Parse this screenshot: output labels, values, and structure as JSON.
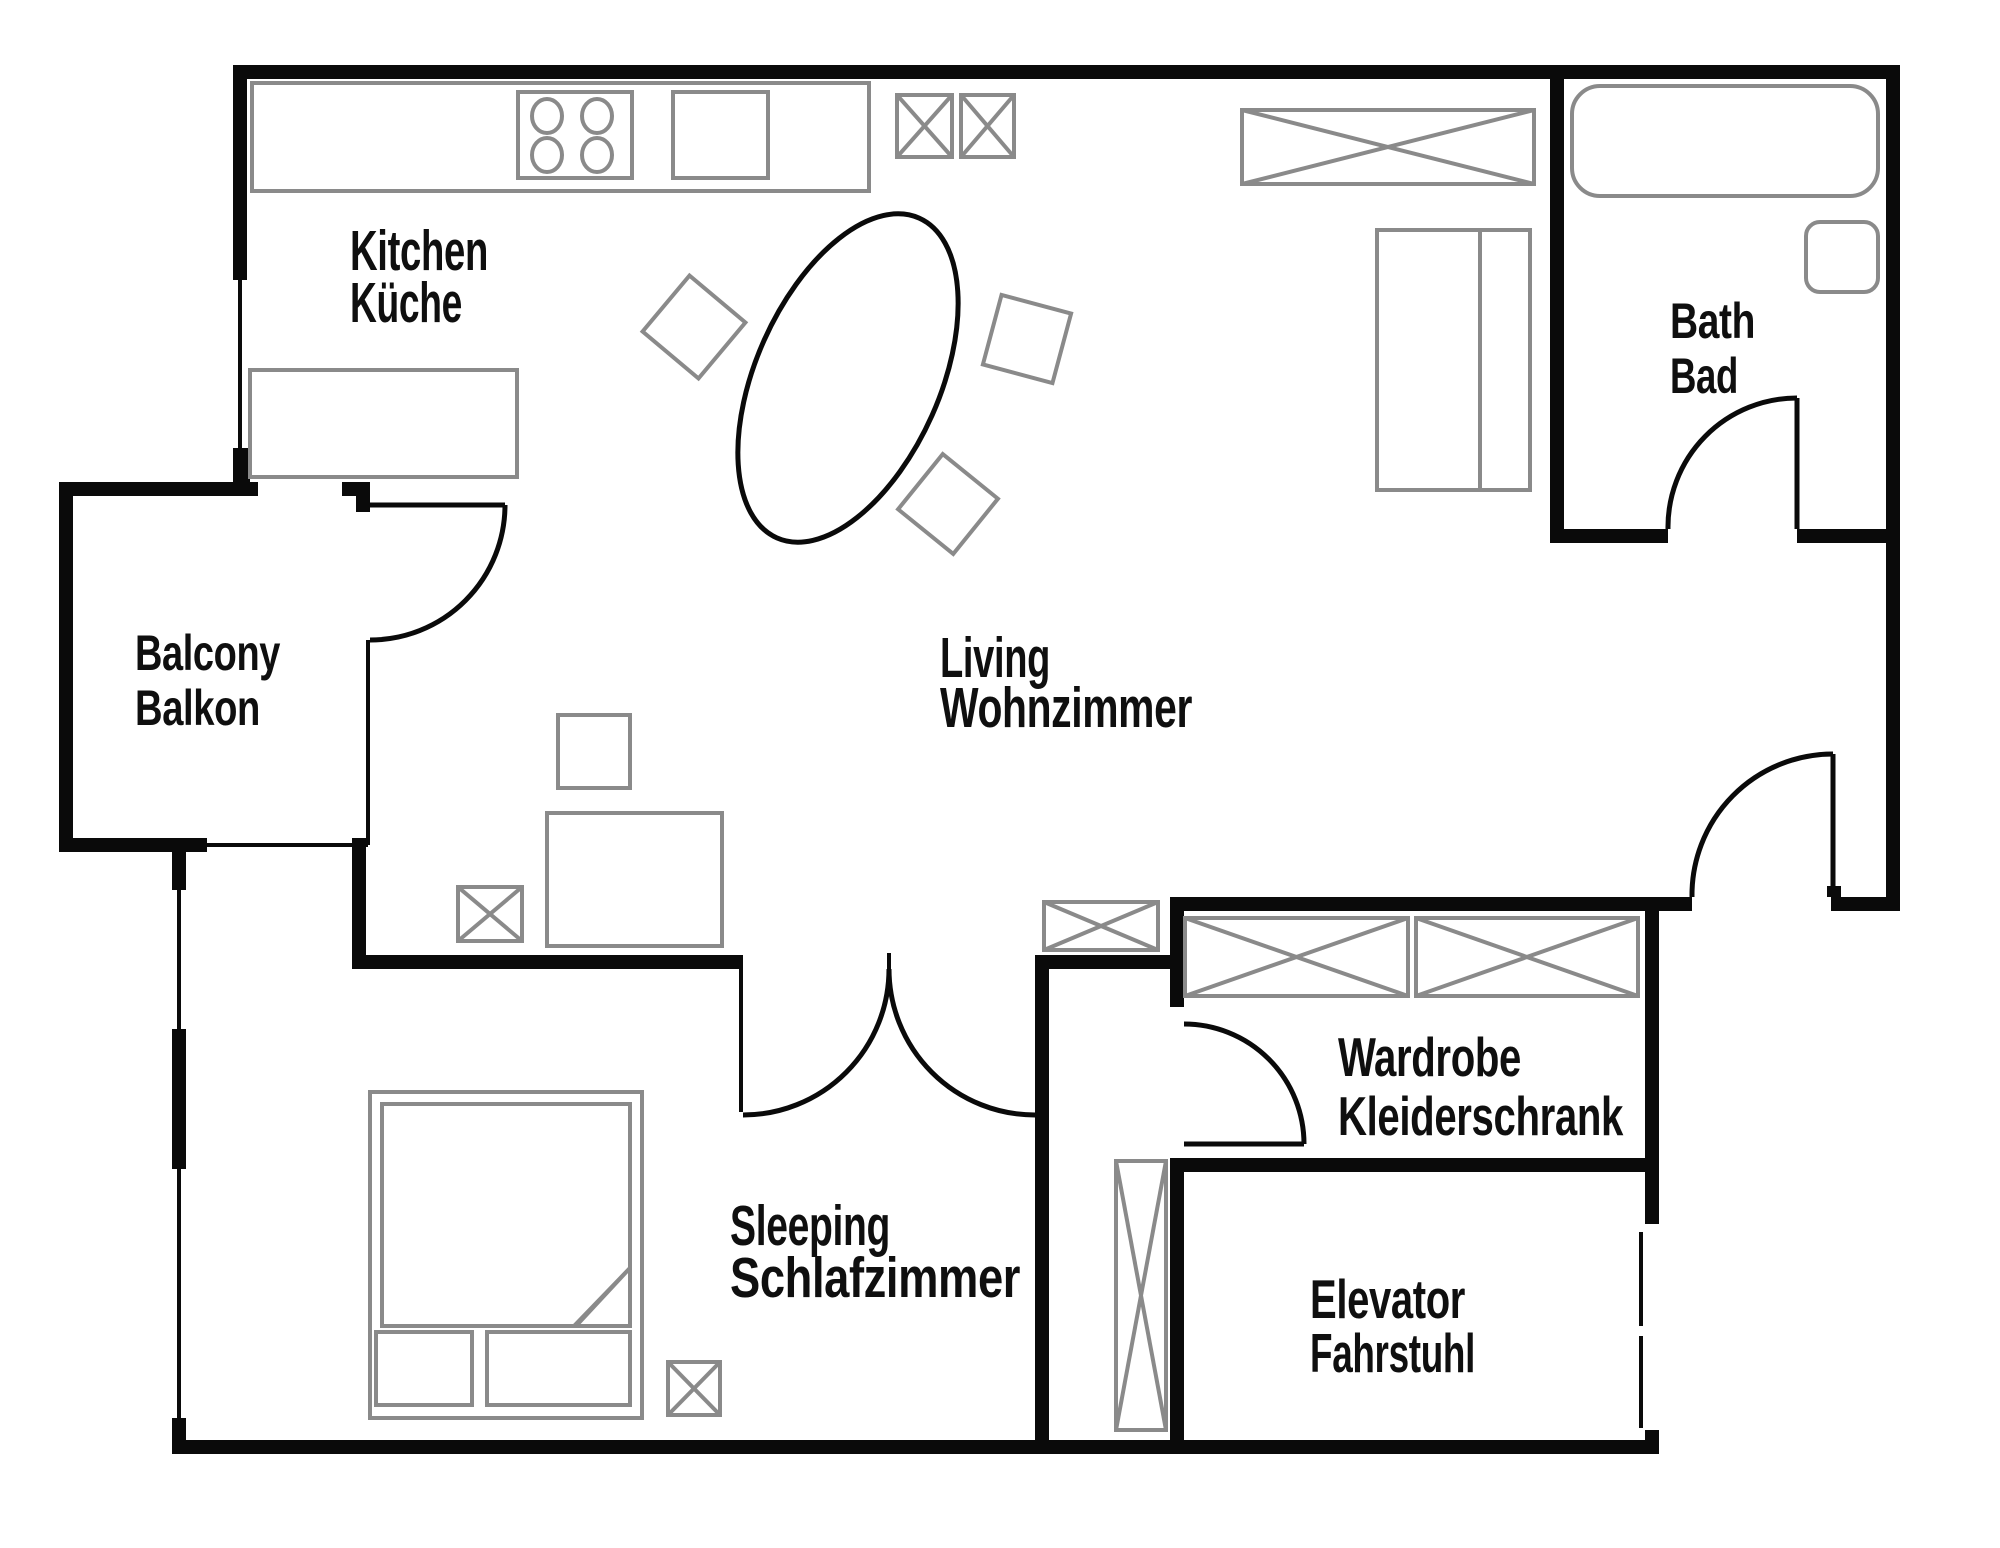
{
  "document_type": "apartment-floor-plan",
  "colors": {
    "background": "#ffffff",
    "wall": "#0a0a0a",
    "furniture_outline": "#8a8a8a",
    "label_text": "#0f0f0f"
  },
  "rooms": {
    "kitchen": {
      "label_en": "Kitchen",
      "label_de": "Küche"
    },
    "living": {
      "label_en": "Living",
      "label_de": "Wohnzimmer"
    },
    "bath": {
      "label_en": "Bath",
      "label_de": "Bad"
    },
    "balcony": {
      "label_en": "Balcony",
      "label_de": "Balkon"
    },
    "sleeping": {
      "label_en": "Sleeping",
      "label_de": "Schlafzimmer"
    },
    "wardrobe": {
      "label_en": "Wardrobe",
      "label_de": "Kleiderschrank"
    },
    "elevator": {
      "label_en": "Elevator",
      "label_de": "Fahrstuhl"
    }
  },
  "symbols": [
    "kitchen-counter",
    "stove-4-burners",
    "kitchen-sink",
    "lower-counter",
    "ventilation-x-box-small-1",
    "ventilation-x-box-small-2",
    "closet-x-box-top-right",
    "tall-cabinet-with-divider",
    "bathtub",
    "toilet",
    "dining-table-oval",
    "chair-1",
    "chair-2",
    "chair-3",
    "desk",
    "desk-chair-square",
    "desk-x-box",
    "bed-double",
    "mattress-with-fold",
    "bed-drawer-1",
    "bed-drawer-2",
    "sleeping-x-box",
    "living-x-box",
    "wardrobe-x-box-1",
    "wardrobe-x-box-2",
    "elevator-shaft-x-box",
    "balcony-door-swing",
    "bath-door-swing",
    "entrance-door-swing",
    "wardrobe-door-swing",
    "sleeping-double-door-swing",
    "elevator-sliding-door",
    "window-kitchen-west",
    "window-sleeping-west-upper",
    "window-sleeping-west-lower",
    "balcony-railing"
  ]
}
